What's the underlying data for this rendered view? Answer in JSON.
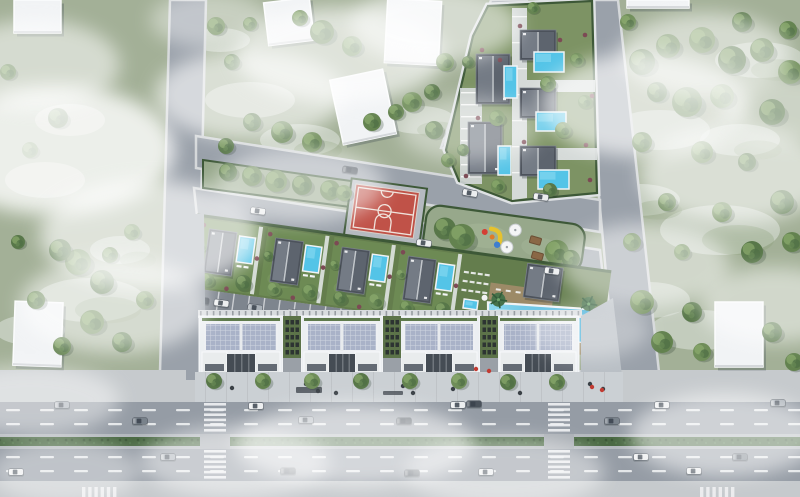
{
  "meta": {
    "description": "Aerial 3D architectural render of a residential site plan: a mixed-use block with four commercial buildings, rooftop villas with pools, a long swimming pool, a villa compound, basketball court, playground, internal streets and a multi-lane highway with crosswalks, surrounded by green fields, trees and clouds",
    "width": 800,
    "height": 497
  },
  "colors": {
    "field": "#a3b097",
    "fieldLight": "#dfe3dc",
    "street": "#9aa1aa",
    "road": "#959ca5",
    "curb": "#b3b8bd",
    "sidewalk": "#c6cacd",
    "hedge": "#3d5837",
    "hedgeFill": "#4a6943",
    "islandGrass": "#97a88b",
    "lawn": "#7d9364",
    "plotLawn": "#6d8a54",
    "bandLawn": "#647d4d",
    "court": "#c05248",
    "courtPad": "#b5bac0",
    "courtLine": "#f2eae3",
    "poolA": "#54c4e7",
    "poolHi": "#8edcf2",
    "roofDark": "#4c525b",
    "blockWhite": "#eceff2",
    "blockRoof": "#a9b2c8",
    "storefront": "#454c54",
    "deckWood": "#9c8a67",
    "parking": "#7e858e",
    "plaza": "#b9bfc5",
    "bush": "#7c4a54",
    "umbrella": "#f4f5f6",
    "table": "#8a6746",
    "slide": "#e6c22e",
    "playRed": "#d43f34",
    "playBlue": "#3e7ecf",
    "playOrange": "#e07b28",
    "building": "#f1f3f5",
    "cars": [
      "#eceeef",
      "#a9b0b7",
      "#4a525b",
      "#79828b"
    ],
    "treeShades": [
      "#587749",
      "#63824f",
      "#6f8d59"
    ]
  },
  "scene": {
    "patches": [
      [
        45,
        180,
        40,
        18
      ],
      [
        90,
        300,
        55,
        22
      ],
      [
        30,
        330,
        35,
        15
      ],
      [
        120,
        250,
        30,
        14
      ],
      [
        250,
        100,
        45,
        18
      ],
      [
        300,
        140,
        40,
        16
      ],
      [
        220,
        40,
        30,
        12
      ],
      [
        420,
        120,
        35,
        14
      ],
      [
        660,
        130,
        50,
        20
      ],
      [
        720,
        230,
        60,
        25
      ],
      [
        650,
        300,
        40,
        18
      ],
      [
        760,
        60,
        45,
        18
      ],
      [
        700,
        330,
        50,
        20
      ],
      [
        640,
        200,
        40,
        16
      ],
      [
        70,
        120,
        35,
        16
      ],
      [
        740,
        140,
        40,
        16
      ]
    ],
    "roads": [
      {
        "name": "left-street",
        "pts": "170,0 206,0 197,372 160,372"
      },
      {
        "name": "right-street",
        "pts": "581,0 618,0 659,372 615,372"
      },
      {
        "name": "north-street",
        "pts": "196,136 600,200 600,232 196,168"
      },
      {
        "name": "south-street",
        "pts": "194,188 600,250 604,286 197,216"
      },
      {
        "name": "top-access-road",
        "pts": "491,0 527,0 472,153 441,148"
      }
    ],
    "highway": {
      "bands": [
        [
          370,
          32,
          "sidewalk"
        ],
        [
          402,
          32,
          "road"
        ],
        [
          434,
          3,
          "curb"
        ],
        [
          437,
          9,
          "hedgeFill"
        ],
        [
          446,
          3,
          "curb"
        ],
        [
          449,
          32,
          "road"
        ],
        [
          481,
          16,
          "sidewalk"
        ]
      ],
      "dashUpper": [
        409,
        423
      ],
      "dashLower": [
        456,
        470
      ],
      "crosswalks": [
        204,
        548
      ],
      "edgeZebras": [
        82,
        700
      ]
    },
    "island": {
      "strip": "203,160 358,182 358,208 203,188",
      "court": {
        "x": 356,
        "y": 184,
        "rot": 7.8
      },
      "playground": {
        "x": 428,
        "y": 204,
        "rot": 7.8
      }
    },
    "compound": {
      "lawn": "M488,6 L592,1 L597,193 L512,201 L459,181 L446,150 L473,36 Z",
      "villas": [
        [
          476,
          54,
          34,
          50
        ],
        [
          468,
          122,
          34,
          52
        ],
        [
          520,
          30,
          36,
          30
        ],
        [
          520,
          88,
          36,
          30
        ],
        [
          520,
          146,
          36,
          30
        ]
      ],
      "pools": [
        [
          504,
          66,
          13,
          32
        ],
        [
          498,
          146,
          13,
          29
        ],
        [
          534,
          52,
          30,
          20
        ],
        [
          536,
          112,
          30,
          19
        ],
        [
          538,
          170,
          31,
          19
        ]
      ],
      "bushes": [
        [
          482,
          50
        ],
        [
          520,
          26
        ],
        [
          585,
          35
        ],
        [
          478,
          118
        ],
        [
          524,
          142
        ],
        [
          586,
          145
        ],
        [
          536,
          196
        ],
        [
          592,
          96
        ],
        [
          466,
          176
        ],
        [
          500,
          60
        ],
        [
          560,
          40
        ],
        [
          590,
          180
        ]
      ]
    },
    "complex": {
      "pivot": [
        197,
        216
      ],
      "angle": 7.8,
      "plots": [
        5,
        72,
        139,
        206
      ],
      "parkCars": [
        [
          16,
          2
        ],
        [
          36,
          0
        ],
        [
          70,
          1
        ],
        [
          110,
          0
        ],
        [
          150,
          3
        ],
        [
          172,
          0
        ],
        [
          196,
          1
        ],
        [
          230,
          0
        ],
        [
          258,
          2
        ]
      ],
      "blocks": [
        [
          199,
          84
        ],
        [
          301,
          82
        ],
        [
          398,
          82
        ],
        [
          497,
          82
        ]
      ],
      "courtyards": [
        283,
        383,
        480
      ],
      "plaza": "581,316 613,298 622,376 581,376",
      "benches": [
        [
          296,
          387,
          26,
          6
        ],
        [
          383,
          391,
          20,
          4
        ]
      ],
      "people": [
        [
          306,
          384
        ],
        [
          318,
          391
        ],
        [
          403,
          386
        ],
        [
          413,
          393
        ],
        [
          453,
          389
        ],
        [
          520,
          393
        ],
        [
          590,
          384
        ],
        [
          603,
          389
        ],
        [
          232,
          388
        ],
        [
          336,
          393
        ]
      ],
      "redDots": [
        [
          476,
          369
        ],
        [
          489,
          371
        ],
        [
          592,
          387
        ],
        [
          602,
          390
        ]
      ]
    },
    "buildings": [
      [
        14,
        0,
        47,
        33,
        0
      ],
      [
        266,
        0,
        46,
        43,
        -7
      ],
      [
        386,
        0,
        54,
        64,
        3
      ],
      [
        336,
        74,
        54,
        66,
        -12
      ],
      [
        627,
        0,
        62,
        8,
        0
      ],
      [
        14,
        302,
        48,
        64,
        2
      ],
      [
        715,
        302,
        48,
        65,
        0
      ]
    ],
    "trees": [
      [
        58,
        118,
        10
      ],
      [
        30,
        150,
        8
      ],
      [
        78,
        262,
        13
      ],
      [
        102,
        282,
        12
      ],
      [
        36,
        300,
        9
      ],
      [
        92,
        322,
        12
      ],
      [
        122,
        342,
        10
      ],
      [
        62,
        346,
        9
      ],
      [
        132,
        232,
        8
      ],
      [
        18,
        242,
        7
      ],
      [
        8,
        72,
        8
      ],
      [
        145,
        300,
        9
      ],
      [
        60,
        250,
        11
      ],
      [
        110,
        255,
        8
      ],
      [
        216,
        26,
        9
      ],
      [
        232,
        62,
        8
      ],
      [
        322,
        32,
        12
      ],
      [
        352,
        46,
        10
      ],
      [
        252,
        122,
        9
      ],
      [
        282,
        132,
        11
      ],
      [
        312,
        142,
        10
      ],
      [
        226,
        146,
        8
      ],
      [
        372,
        122,
        9
      ],
      [
        412,
        102,
        10
      ],
      [
        434,
        130,
        9
      ],
      [
        396,
        112,
        8
      ],
      [
        445,
        62,
        9
      ],
      [
        432,
        92,
        8
      ],
      [
        250,
        24,
        7
      ],
      [
        300,
        18,
        8
      ],
      [
        642,
        62,
        13
      ],
      [
        668,
        46,
        12
      ],
      [
        702,
        40,
        13
      ],
      [
        732,
        60,
        14
      ],
      [
        762,
        50,
        12
      ],
      [
        790,
        72,
        12
      ],
      [
        657,
        92,
        10
      ],
      [
        687,
        102,
        15
      ],
      [
        722,
        96,
        12
      ],
      [
        772,
        112,
        13
      ],
      [
        642,
        142,
        10
      ],
      [
        702,
        152,
        11
      ],
      [
        747,
        162,
        9
      ],
      [
        667,
        202,
        9
      ],
      [
        722,
        212,
        10
      ],
      [
        782,
        202,
        12
      ],
      [
        632,
        242,
        9
      ],
      [
        682,
        252,
        8
      ],
      [
        752,
        252,
        11
      ],
      [
        792,
        242,
        10
      ],
      [
        642,
        302,
        12
      ],
      [
        692,
        312,
        10
      ],
      [
        662,
        342,
        11
      ],
      [
        702,
        352,
        9
      ],
      [
        772,
        332,
        10
      ],
      [
        794,
        362,
        9
      ],
      [
        628,
        22,
        8
      ],
      [
        742,
        22,
        10
      ],
      [
        788,
        30,
        9
      ],
      [
        497,
        118,
        8
      ],
      [
        468,
        62,
        6
      ],
      [
        548,
        84,
        8
      ],
      [
        563,
        130,
        8
      ],
      [
        550,
        190,
        7
      ],
      [
        585,
        102,
        7
      ],
      [
        498,
        186,
        7
      ],
      [
        463,
        150,
        6
      ],
      [
        533,
        8,
        6
      ],
      [
        577,
        60,
        7
      ],
      [
        228,
        172,
        9
      ],
      [
        252,
        176,
        10
      ],
      [
        276,
        181,
        11
      ],
      [
        302,
        185,
        10
      ],
      [
        330,
        190,
        10
      ],
      [
        344,
        193,
        8
      ],
      [
        214,
        381,
        8
      ],
      [
        263,
        381,
        8
      ],
      [
        312,
        381,
        8
      ],
      [
        361,
        381,
        8
      ],
      [
        410,
        381,
        8
      ],
      [
        459,
        381,
        8
      ],
      [
        508,
        382,
        8
      ],
      [
        557,
        382,
        8
      ],
      [
        448,
        160,
        7
      ]
    ],
    "cars": [
      [
        62,
        405,
        0,
        1
      ],
      [
        140,
        421,
        0,
        3
      ],
      [
        256,
        406,
        0,
        0
      ],
      [
        306,
        420,
        0,
        1
      ],
      [
        404,
        421,
        0,
        2
      ],
      [
        458,
        405,
        0,
        0
      ],
      [
        474,
        404,
        0,
        2
      ],
      [
        612,
        421,
        0,
        3
      ],
      [
        662,
        405,
        0,
        0
      ],
      [
        778,
        403,
        0,
        1
      ],
      [
        168,
        457,
        0,
        1
      ],
      [
        16,
        472,
        0,
        0
      ],
      [
        288,
        471,
        0,
        2
      ],
      [
        412,
        473,
        0,
        2
      ],
      [
        486,
        472,
        0,
        0
      ],
      [
        641,
        457,
        0,
        0
      ],
      [
        694,
        471,
        0,
        0
      ],
      [
        740,
        457,
        0,
        3
      ],
      [
        350,
        170,
        8,
        2
      ],
      [
        258,
        211,
        8,
        0
      ],
      [
        424,
        243,
        8,
        0
      ],
      [
        541,
        197,
        8,
        0
      ],
      [
        552,
        271,
        8,
        0
      ],
      [
        470,
        193,
        10,
        0
      ]
    ],
    "clouds": [
      [
        55,
        150,
        120,
        65,
        0.8
      ],
      [
        150,
        235,
        110,
        55,
        0.65
      ],
      [
        35,
        65,
        85,
        45,
        0.55
      ],
      [
        250,
        95,
        95,
        45,
        0.6
      ],
      [
        340,
        55,
        105,
        48,
        0.65
      ],
      [
        300,
        185,
        85,
        38,
        0.5
      ],
      [
        435,
        25,
        85,
        38,
        0.55
      ],
      [
        470,
        130,
        70,
        32,
        0.4
      ],
      [
        645,
        105,
        105,
        52,
        0.65
      ],
      [
        735,
        175,
        95,
        48,
        0.6
      ],
      [
        705,
        55,
        85,
        42,
        0.55
      ],
      [
        645,
        265,
        85,
        42,
        0.5
      ],
      [
        775,
        305,
        75,
        38,
        0.5
      ],
      [
        355,
        445,
        120,
        42,
        0.6
      ],
      [
        235,
        462,
        95,
        36,
        0.5
      ],
      [
        505,
        472,
        100,
        36,
        0.45
      ],
      [
        725,
        435,
        95,
        42,
        0.55
      ],
      [
        65,
        472,
        75,
        32,
        0.4
      ],
      [
        115,
        305,
        95,
        48,
        0.55
      ],
      [
        785,
        110,
        65,
        35,
        0.45
      ],
      [
        210,
        20,
        60,
        28,
        0.4
      ],
      [
        590,
        330,
        60,
        28,
        0.35
      ],
      [
        30,
        400,
        90,
        35,
        0.45
      ]
    ]
  }
}
